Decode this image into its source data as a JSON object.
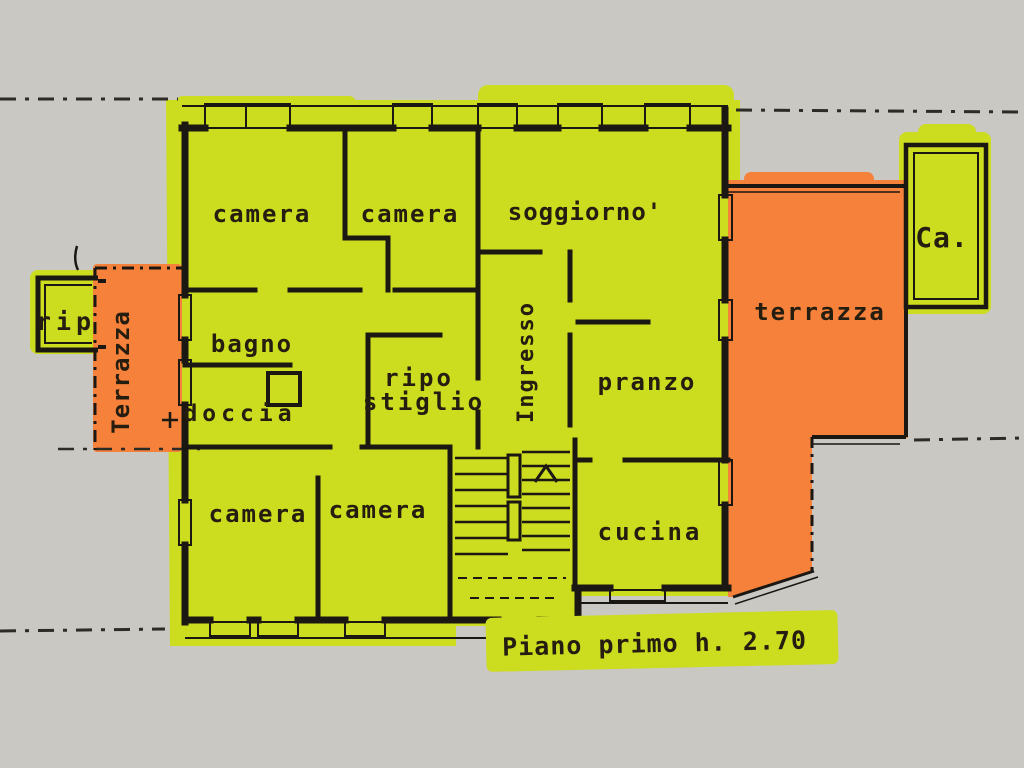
{
  "plan": {
    "caption": "Piano primo h. 2.70",
    "rooms": {
      "camera_top_left": "camera",
      "camera_top_middle": "camera",
      "soggiorno": "soggiorno'",
      "bagno": "bagno",
      "doccia": "doccia",
      "ripostiglio": {
        "line1": "ripo",
        "line2": "stiglio"
      },
      "ingresso": "Ingresso",
      "pranzo": "pranzo",
      "cucina": "cucina",
      "camera_bottom_left": "camera",
      "camera_bottom_middle": "camera",
      "storage_rip": "rip",
      "terrace_left": "Terrazza",
      "terrace_right": "terrazza",
      "room_ca": "Ca."
    },
    "colors": {
      "highlight_yellow": "#ccdc1e",
      "highlight_orange": "#f5813a",
      "ink": "#1b1712",
      "paper": "#c9c8c3"
    }
  }
}
